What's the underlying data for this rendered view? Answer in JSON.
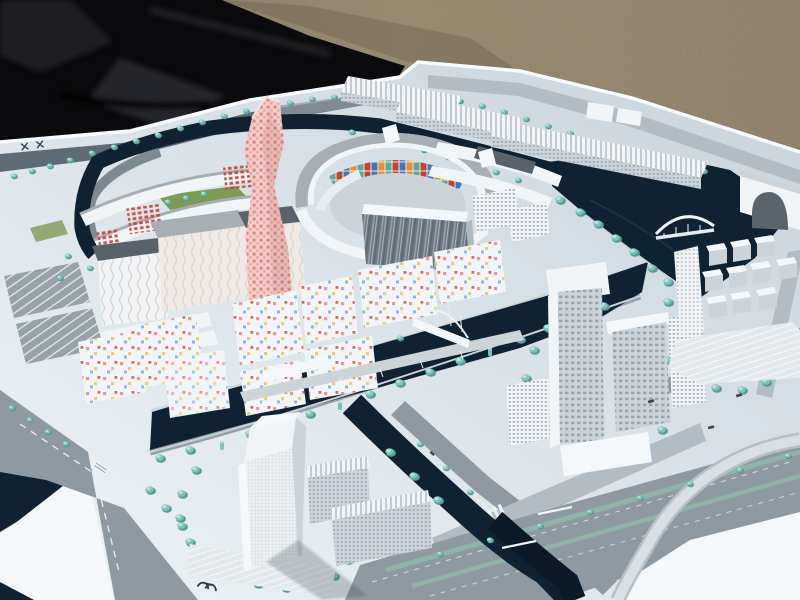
{
  "meta": {
    "subject": "Architectural scale model of a waterfront urban master plan, photographed outdoors on gravel ground with a black cloth beside the white model board"
  },
  "palette": {
    "ground": "#8f8068",
    "ground_dark": "#6f6350",
    "cloth": "#0b0b0e",
    "cloth_fold": "#232328",
    "base": "#dde5eb",
    "base_bright": "#f4f8fa",
    "base_shade": "#c6d0d7",
    "fascia": "#f8fbfd",
    "road": "#8f99a1",
    "road_dark": "#5f6b74",
    "road_light": "#b3bcc2",
    "water": "#0e2233",
    "water_soft": "#1d3a4e",
    "shore": "#c9d2d7",
    "tree": "#7cc4bb",
    "tree_dark": "#569e95",
    "tree_light": "#b7e2dc",
    "lawn": "#7d9b55",
    "bldg": "#f2f5f7",
    "bldg_shade": "#ccd4da",
    "bldg_shade2": "#aeb8bf",
    "roof": "#a7aeb4",
    "roof_dark": "#59626b",
    "glass": "#6d7681",
    "glass_light": "#95a0a8",
    "pink": "#f0cdca",
    "pink_dot": "#e06a5a",
    "mosaic_red": "#c8402e",
    "mosaic_blue": "#3b78c4",
    "mosaic_orange": "#e98f31",
    "mosaic_teal": "#59a89c",
    "mosaic_cream": "#efeadb",
    "dot_red": "#e89898",
    "dot_yellow": "#f0cc74",
    "dot_blue": "#8fb6e0",
    "window": "#9aa4ac",
    "shadow": "#3a444d"
  },
  "markings": {
    "cross_marks": "✕ ✕"
  }
}
